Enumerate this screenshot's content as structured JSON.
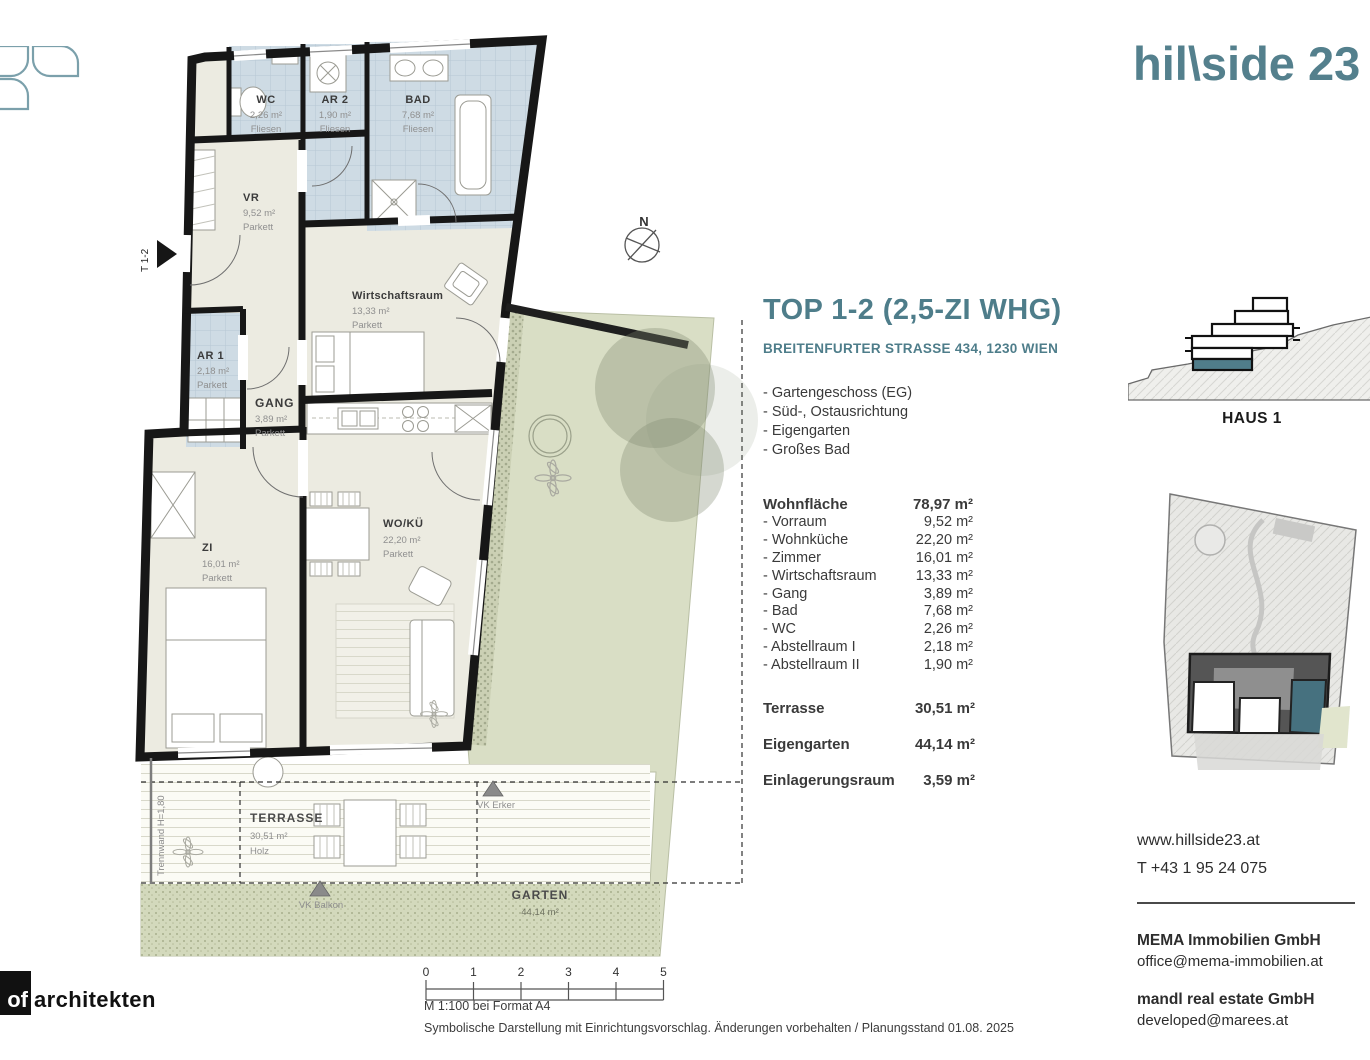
{
  "branding": {
    "logo": "hil\\side 23",
    "architect_box": "of",
    "architect_name": "architekten"
  },
  "floorplan": {
    "rooms": [
      {
        "name": "WC",
        "area": "2,26 m²",
        "floor": "Fliesen"
      },
      {
        "name": "AR 2",
        "area": "1,90 m²",
        "floor": "Fliesen"
      },
      {
        "name": "BAD",
        "area": "7,68 m²",
        "floor": "Fliesen"
      },
      {
        "name": "VR",
        "area": "9,52 m²",
        "floor": "Parkett"
      },
      {
        "name": "Wirtschaftsraum",
        "area": "13,33 m²",
        "floor": "Parkett"
      },
      {
        "name": "AR 1",
        "area": "2,18 m²",
        "floor": "Parkett"
      },
      {
        "name": "GANG",
        "area": "3,89 m²",
        "floor": "Parkett"
      },
      {
        "name": "ZI",
        "area": "16,01 m²",
        "floor": "Parkett"
      },
      {
        "name": "WO/KÜ",
        "area": "22,20 m²",
        "floor": "Parkett"
      }
    ],
    "outdoor": {
      "terrasse": {
        "name": "TERRASSE",
        "area": "30,51 m²",
        "floor": "Holz"
      },
      "garten": {
        "name": "GARTEN",
        "area": "44,14 m²"
      }
    },
    "markers": {
      "north": "N",
      "entry": "T 1-2",
      "trennwand": "Trennwand H=1,80",
      "vk_erker": "VK Erker",
      "vk_balkon": "VK Balkon"
    }
  },
  "details": {
    "title": "TOP 1-2 (2,5-ZI WHG)",
    "address": "BREITENFURTER STRASSE 434, 1230 WIEN",
    "features": [
      "- Gartengeschoss (EG)",
      "- Süd-, Ostausrichtung",
      "- Eigengarten",
      "- Großes Bad"
    ],
    "table": {
      "header": {
        "label": "Wohnfläche",
        "value": "78,97 m²"
      },
      "rows": [
        {
          "label": "- Vorraum",
          "value": "9,52 m²"
        },
        {
          "label": "- Wohnküche",
          "value": "22,20 m²"
        },
        {
          "label": "- Zimmer",
          "value": "16,01 m²"
        },
        {
          "label": "- Wirtschaftsraum",
          "value": "13,33 m²"
        },
        {
          "label": "- Gang",
          "value": "3,89 m²"
        },
        {
          "label": "- Bad",
          "value": "7,68 m²"
        },
        {
          "label": "- WC",
          "value": "2,26 m²"
        },
        {
          "label": "- Abstellraum I",
          "value": "2,18 m²"
        },
        {
          "label": "- Abstellraum II",
          "value": "1,90 m²"
        }
      ]
    },
    "extras": [
      {
        "label": "Terrasse",
        "value": "30,51 m²"
      },
      {
        "label": "Eigengarten",
        "value": "44,14 m²"
      },
      {
        "label": "Einlagerungsraum",
        "value": "3,59 m²"
      }
    ]
  },
  "sidebar": {
    "haus": "HAUS 1",
    "website": "www.hillside23.at",
    "phone": "T +43 1 95 24 075",
    "companies": [
      {
        "name": "MEMA Immobilien GmbH",
        "email": "office@mema-immobilien.at"
      },
      {
        "name": "mandl real estate GmbH",
        "email": "developed@marees.at"
      }
    ]
  },
  "footer": {
    "ticks": [
      "0",
      "1",
      "2",
      "3",
      "4",
      "5"
    ],
    "scale_note": "M 1:100 bei Format A4",
    "disclaimer": "Symbolische Darstellung mit Einrichtungsvorschlag. Änderungen vorbehalten / Planungsstand 01.08. 2025"
  },
  "colors": {
    "teal": "#4e7d8a",
    "wall": "#171717",
    "room_fill": "#ecebe1",
    "wet_fill": "#cedbe4",
    "garden": "#d9dec5",
    "unit_highlight": "#46717f"
  }
}
